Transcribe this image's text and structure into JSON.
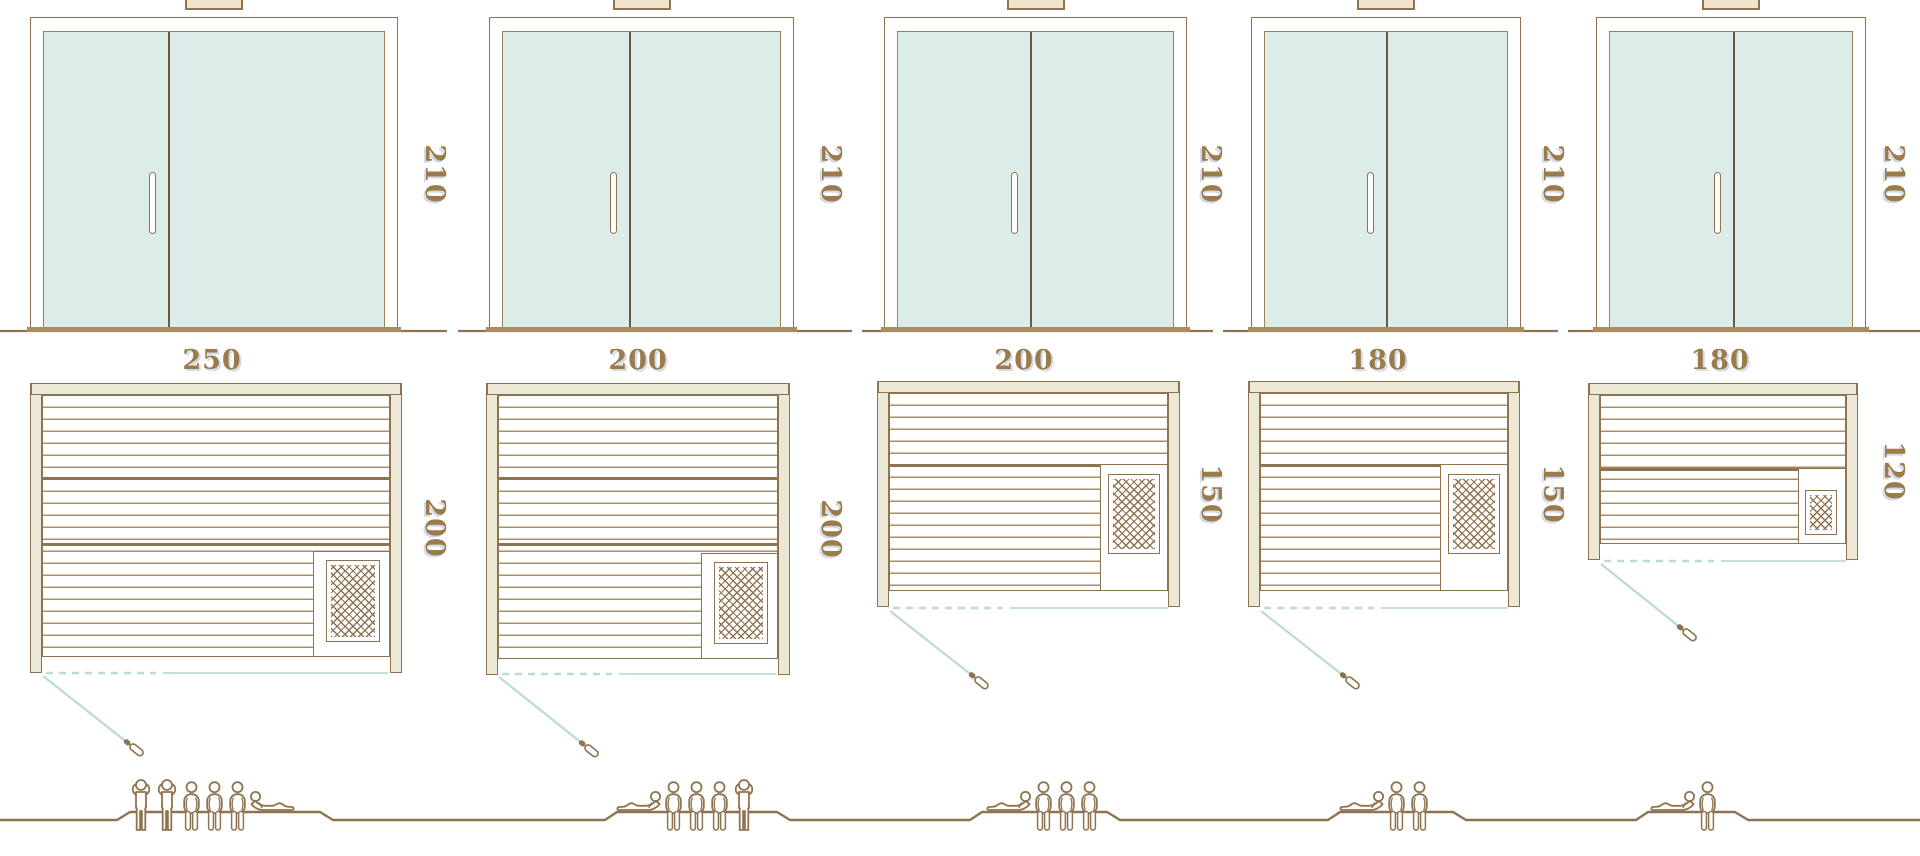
{
  "colors": {
    "outline": "#8F7350",
    "outline_light": "#A98F66",
    "dimension_text": "#9C7B4B",
    "glass": "#DCEDE9",
    "cream": "#EBE8D5",
    "teal_line": "#BBDBD4",
    "threshold": "#A98C5F",
    "shadow_blue": "rgba(148,166,205,0.42)"
  },
  "saunas": [
    {
      "id": "sauna-1",
      "door_height_cm": "210",
      "width_cm": "250",
      "depth_cm": "200",
      "capacity_figures": [
        "standing",
        "standing",
        "sitting",
        "sitting",
        "sitting",
        "lying-mirrored"
      ]
    },
    {
      "id": "sauna-2",
      "door_height_cm": "210",
      "width_cm": "200",
      "depth_cm": "200",
      "capacity_figures": [
        "lying",
        "sitting",
        "sitting",
        "sitting",
        "standing"
      ]
    },
    {
      "id": "sauna-3",
      "door_height_cm": "210",
      "width_cm": "200",
      "depth_cm": "150",
      "capacity_figures": [
        "lying",
        "sitting",
        "sitting",
        "sitting"
      ]
    },
    {
      "id": "sauna-4",
      "door_height_cm": "210",
      "width_cm": "180",
      "depth_cm": "150",
      "capacity_figures": [
        "lying",
        "sitting",
        "sitting"
      ]
    },
    {
      "id": "sauna-5",
      "door_height_cm": "210",
      "width_cm": "180",
      "depth_cm": "120",
      "capacity_figures": [
        "lying",
        "sitting"
      ]
    }
  ]
}
